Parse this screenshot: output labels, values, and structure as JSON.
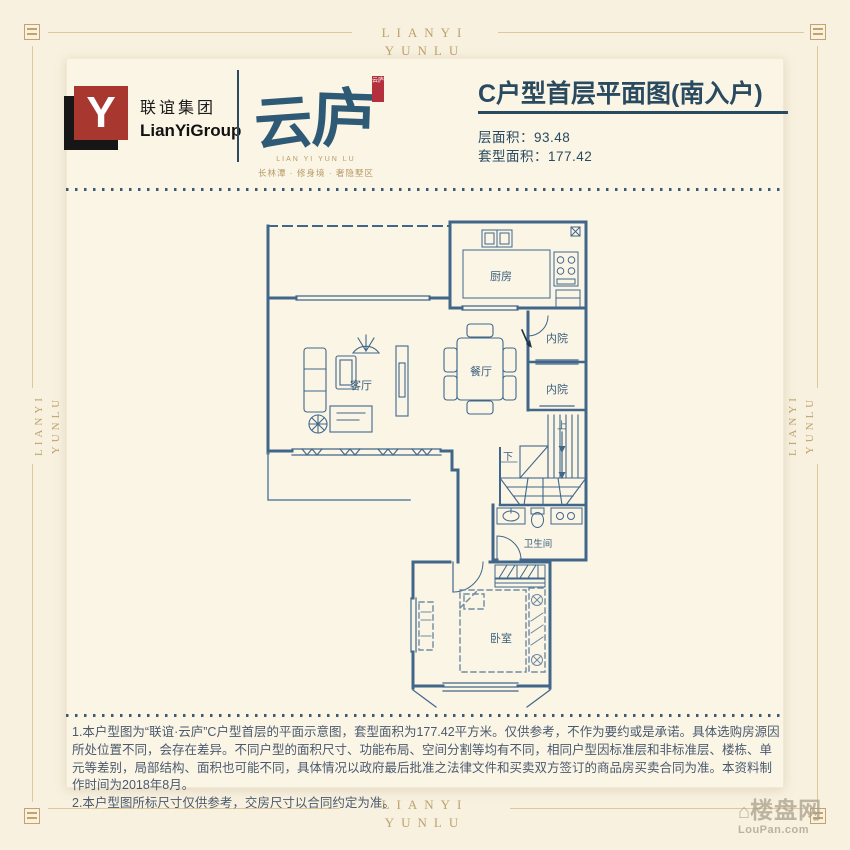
{
  "frame": {
    "brand_line1": "LIANYI",
    "brand_line2": "YUNLU"
  },
  "header": {
    "group_logo_letter": "Y",
    "group_name_cn": "联谊集团",
    "group_name_en": "LianYiGroup",
    "project_name_char1": "云",
    "project_name_char2": "庐",
    "seal_text": "云庐",
    "project_name_en": "LIAN YI YUN LU",
    "project_tagline": "长林潭 · 修身境 · 奢隐墅区"
  },
  "plan_info": {
    "title": "C户型首层平面图(南入户)",
    "floor_area_label": "层面积：",
    "floor_area_value": "93.48",
    "unit_area_label": "套型面积：",
    "unit_area_value": "177.42"
  },
  "floorplan": {
    "labels": {
      "kitchen": "厨房",
      "courtyard_upper": "内院",
      "courtyard_lower": "内院",
      "dining": "餐厅",
      "living": "客厅",
      "bathroom": "卫生间",
      "bedroom": "卧室",
      "stair_up": "上",
      "stair_down": "下"
    }
  },
  "disclaimer": {
    "line1": "1.本户型图为“联谊·云庐”C户型首层的平面示意图，套型面积为177.42平方米。仅供参考，不作为要约或是承诺。具体选购房源因所处位置不同，会存在差异。不同户型的面积尺寸、功能布局、空间分割等均有不同，相同户型因标准层和非标准层、楼栋、单元等差别，局部结构、面积也可能不同，具体情况以政府最后批准之法律文件和买卖双方签订的商品房买卖合同为准。本资料制作时间为2018年8月。",
    "line2": "2.本户型图所标尺寸仅供参考，交房尺寸以合同约定为准。"
  },
  "watermark": {
    "name_cn": "楼盘网",
    "name_en": "LouPan.com"
  },
  "colors": {
    "background": "#f8f1df",
    "card": "#fbf5e6",
    "gold_accent": "#c3a36b",
    "plan_blue": "#40678a",
    "title_navy": "#2a4a60",
    "logo_red": "#a8372f",
    "seal_red": "#b3303c",
    "disclaimer_text": "#4a5a6e"
  }
}
